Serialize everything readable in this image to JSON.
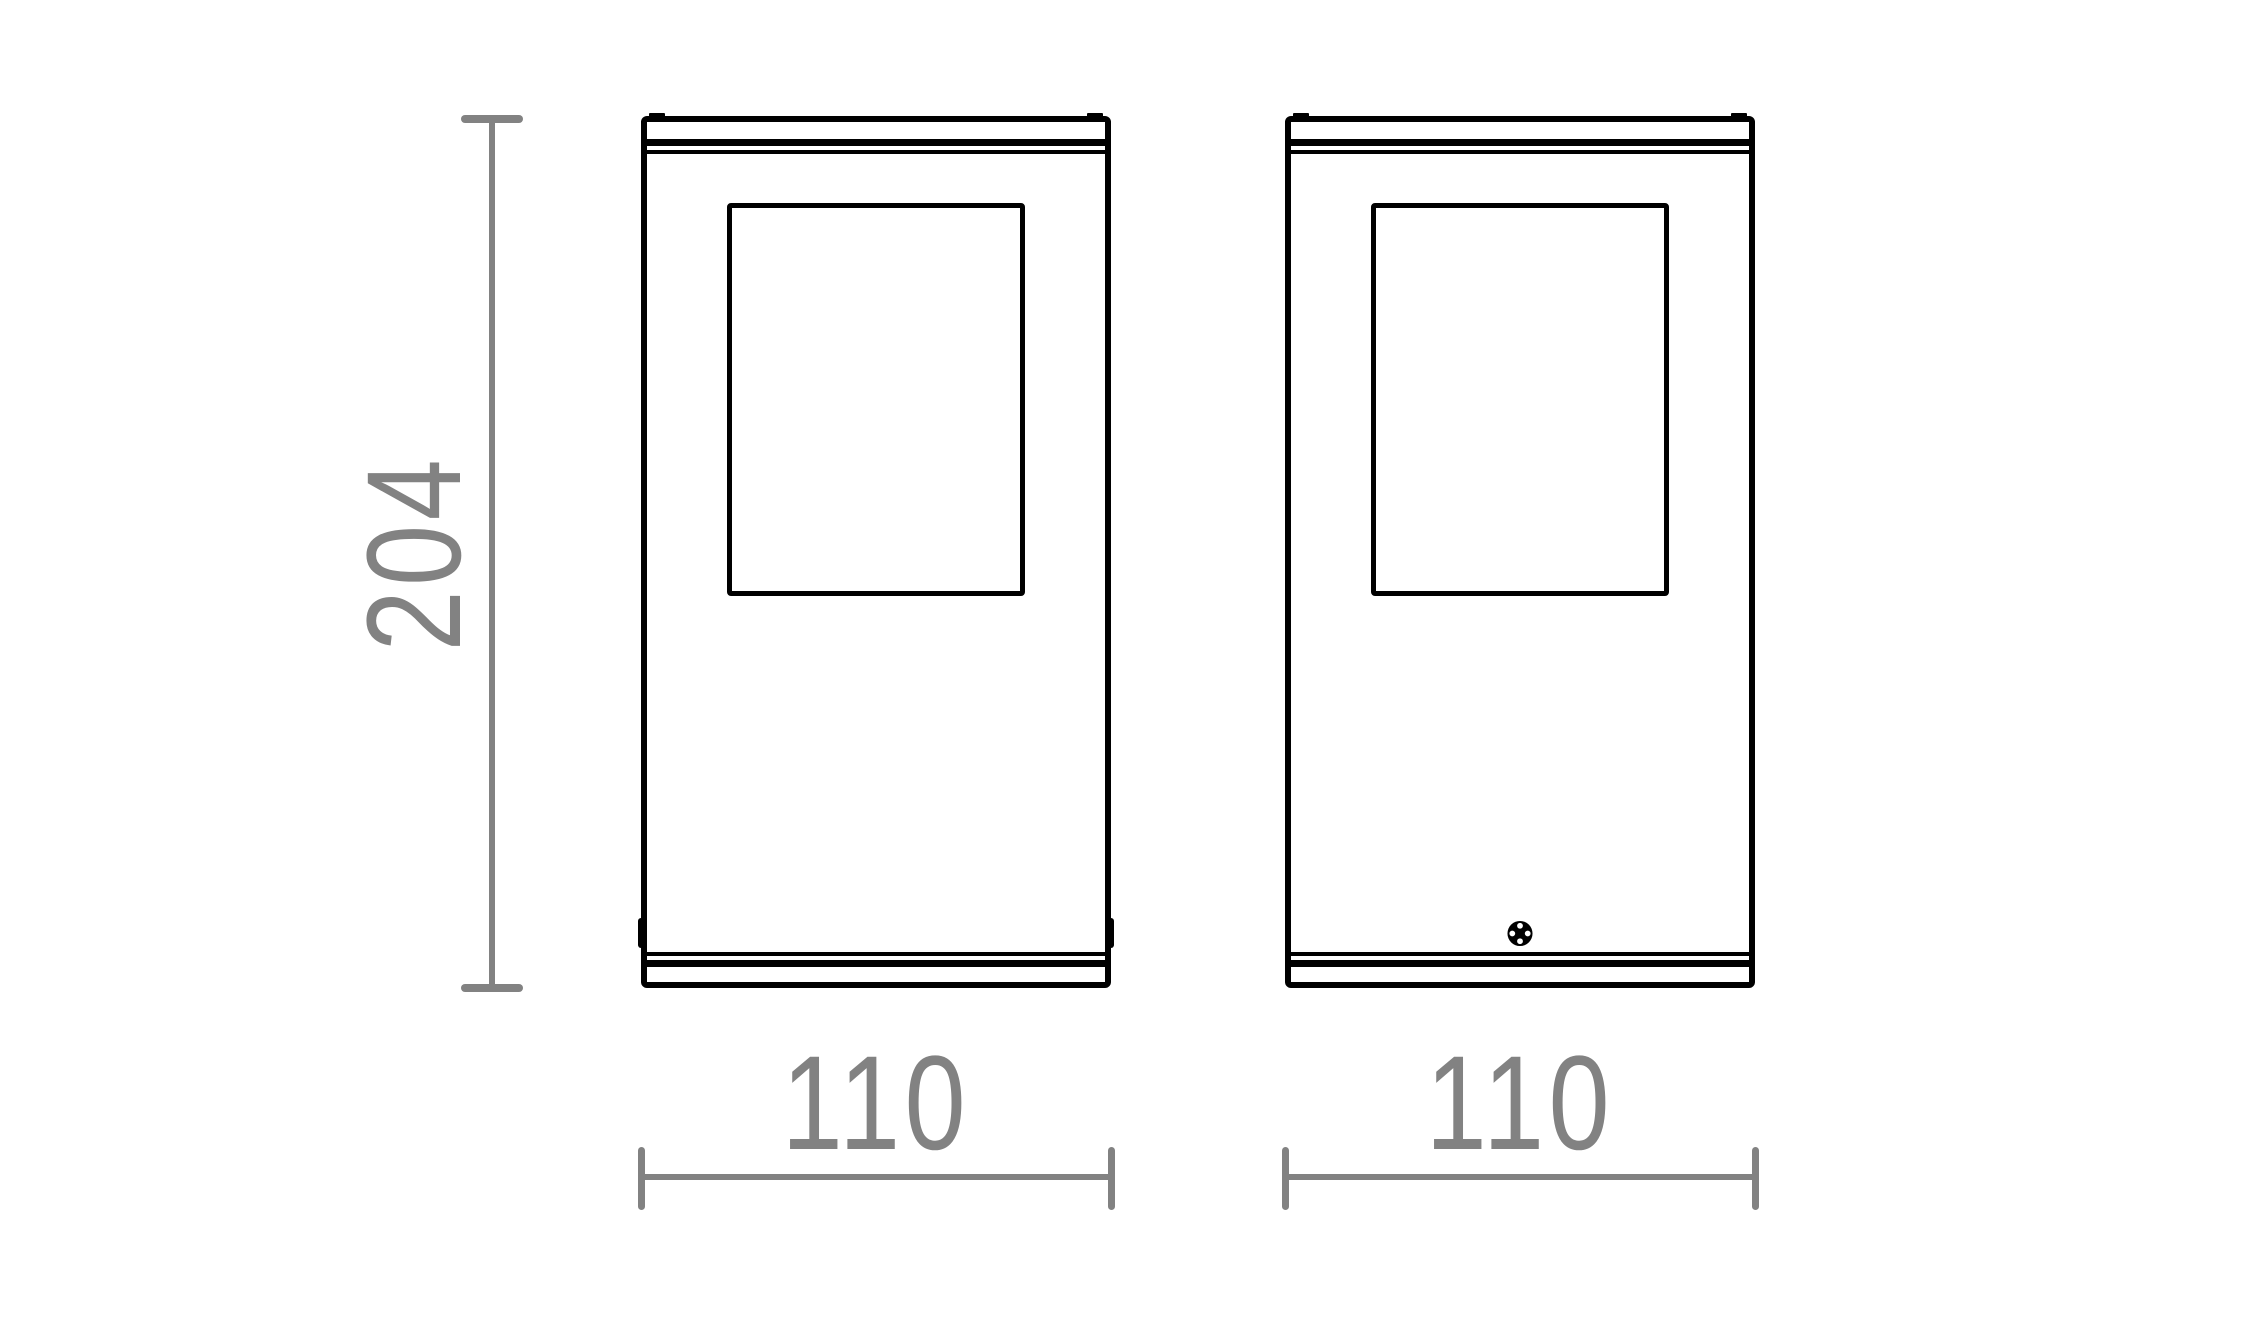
{
  "drawing": {
    "background_color": "#ffffff",
    "outline_color": "#000000",
    "dimension_color": "#828282",
    "height_dimension": {
      "value": "204"
    },
    "views": [
      {
        "id": "front-view",
        "width_dimension": {
          "value": "110"
        }
      },
      {
        "id": "rear-view",
        "width_dimension": {
          "value": "110"
        },
        "screw_icon": "phillips-screw-head"
      }
    ]
  }
}
